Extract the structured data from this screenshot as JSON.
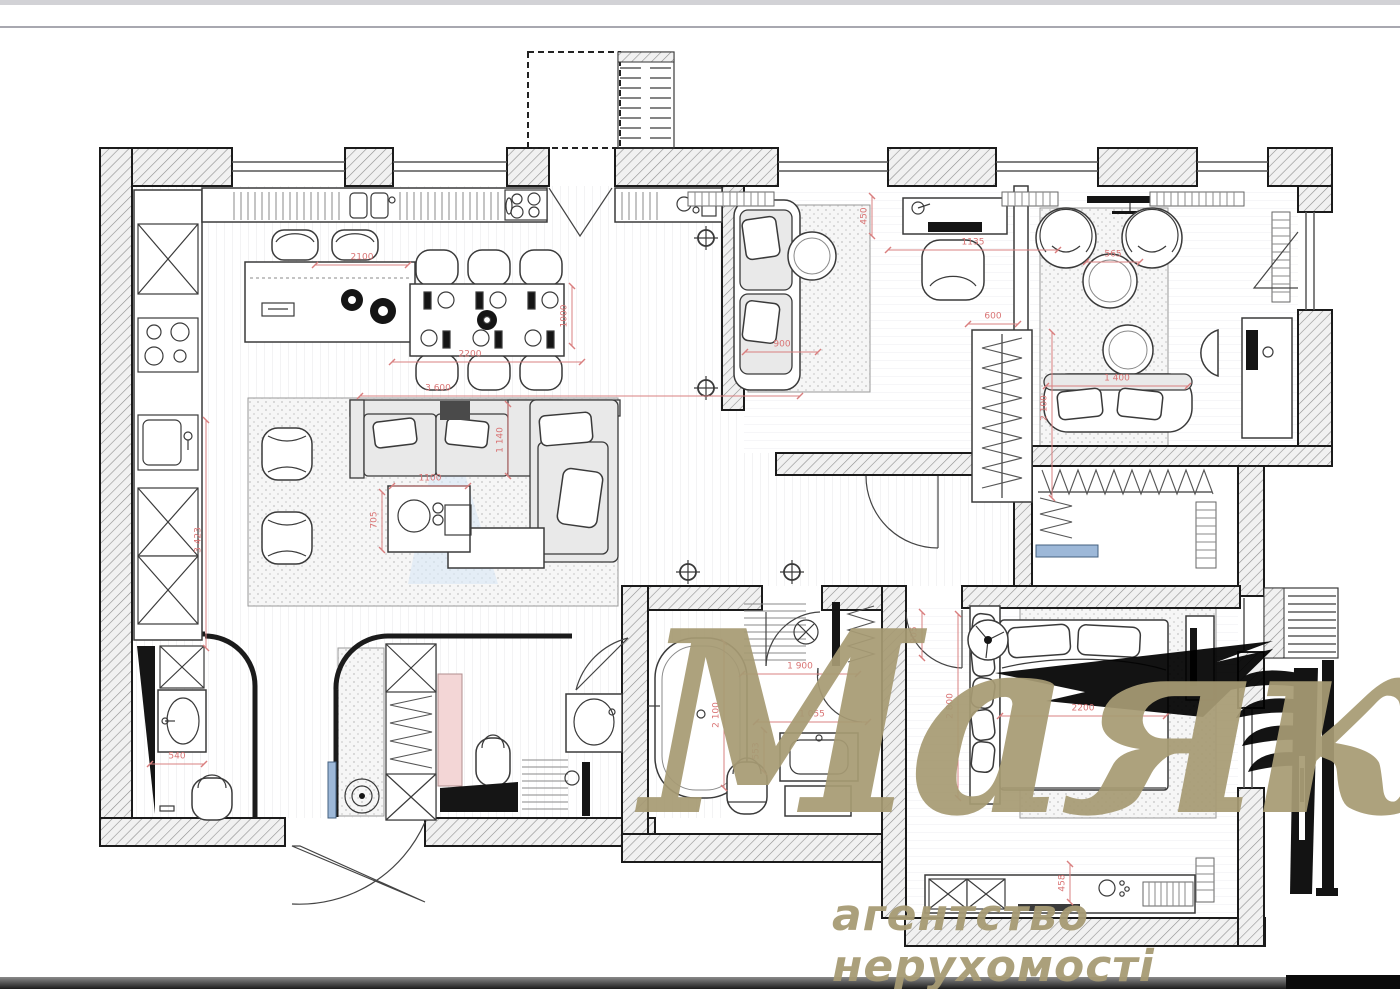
{
  "page": {
    "top_strip_color": "#d2d2d6",
    "separator_color": "#a8a8b0",
    "bottom_bar_color": "#3c3c3c",
    "bottom_bar_right_color": "#0b0b0b",
    "background": "#ffffff"
  },
  "plan": {
    "type": "apartment-floor-plan",
    "wall_color": "#1b1b1b",
    "dimension_color": "#d97474",
    "accent_blue": "#9db8d8",
    "beam_blue": "#d9e6f5",
    "cabinet_pink": "#f3d6d6",
    "dimensions_mm": [
      {
        "t": "2100",
        "x": 362,
        "y": 258,
        "r": 0
      },
      {
        "t": "2200",
        "x": 470,
        "y": 355,
        "r": 0
      },
      {
        "t": "1000",
        "x": 565,
        "y": 316,
        "r": -90
      },
      {
        "t": "3 600",
        "x": 438,
        "y": 389,
        "r": 0
      },
      {
        "t": "1100",
        "x": 430,
        "y": 479,
        "r": 0
      },
      {
        "t": "705",
        "x": 375,
        "y": 520,
        "r": -90
      },
      {
        "t": "1 140",
        "x": 501,
        "y": 440,
        "r": -90
      },
      {
        "t": "3 423",
        "x": 199,
        "y": 540,
        "r": -90
      },
      {
        "t": "900",
        "x": 782,
        "y": 345,
        "r": 0
      },
      {
        "t": "450",
        "x": 865,
        "y": 216,
        "r": -90
      },
      {
        "t": "1135",
        "x": 973,
        "y": 243,
        "r": 0
      },
      {
        "t": "565",
        "x": 1113,
        "y": 255,
        "r": 0
      },
      {
        "t": "600",
        "x": 993,
        "y": 317,
        "r": 0
      },
      {
        "t": "2 100",
        "x": 1045,
        "y": 408,
        "r": -90
      },
      {
        "t": "1 400",
        "x": 1117,
        "y": 379,
        "r": 0
      },
      {
        "t": "905",
        "x": 915,
        "y": 635,
        "r": -90
      },
      {
        "t": "1 900",
        "x": 800,
        "y": 667,
        "r": 0
      },
      {
        "t": "1 055",
        "x": 812,
        "y": 715,
        "r": 0
      },
      {
        "t": "553",
        "x": 757,
        "y": 751,
        "r": -90
      },
      {
        "t": "2 100",
        "x": 717,
        "y": 715,
        "r": -90
      },
      {
        "t": "2200",
        "x": 1083,
        "y": 709,
        "r": 0
      },
      {
        "t": "2 800",
        "x": 951,
        "y": 706,
        "r": -90
      },
      {
        "t": "458",
        "x": 1063,
        "y": 883,
        "r": -90
      },
      {
        "t": "540",
        "x": 177,
        "y": 757,
        "r": 0
      }
    ]
  },
  "watermark": {
    "brand": "Маяк",
    "subtitle": "агентство нерухомості",
    "color": "#a79b74"
  }
}
